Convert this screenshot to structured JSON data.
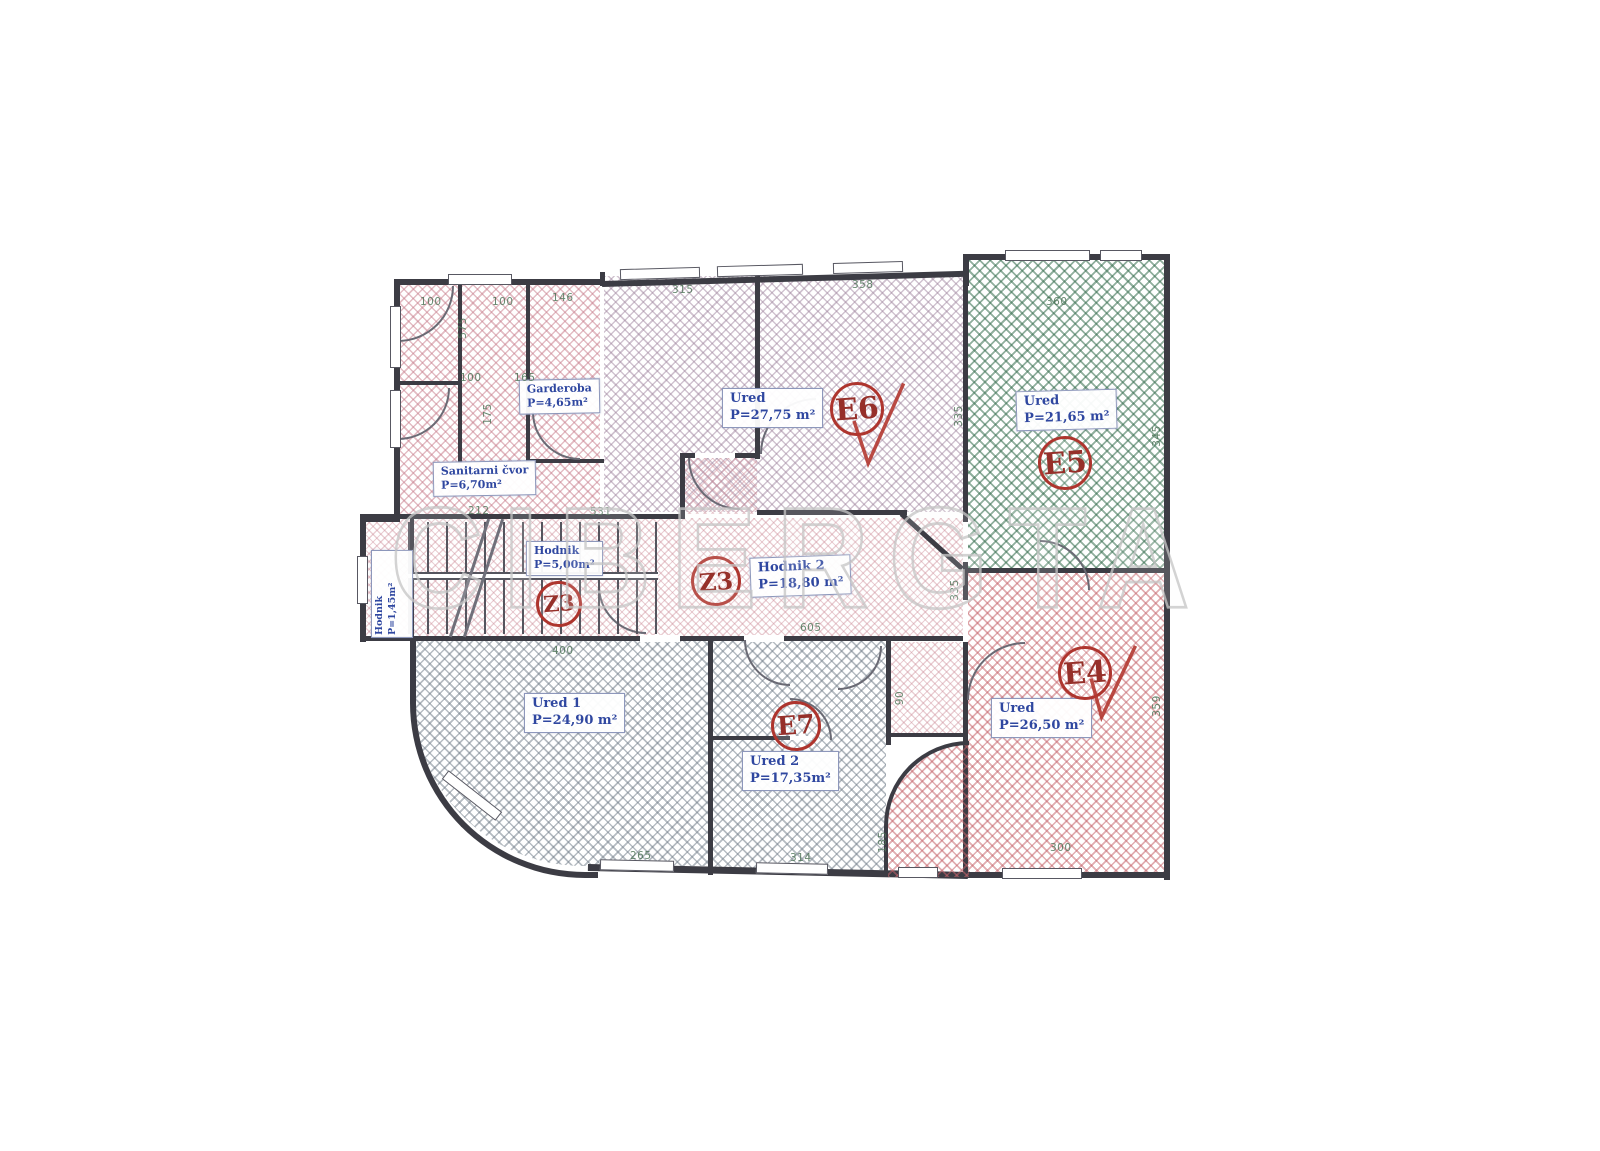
{
  "watermark": {
    "text": "CIBERGTA"
  },
  "colors": {
    "wall": "#3c3c44",
    "label_text": "#2f47a0",
    "marker_red": "#ae352e",
    "hatch_pink": "#c77b8a",
    "hatch_green": "#366e4e",
    "hatch_red": "#c5636a",
    "hatch_gray": "#6e7a86",
    "dim_green": "#4e7458"
  },
  "rooms": {
    "garderoba": {
      "name": "Garderoba",
      "area": "P=4,65m²"
    },
    "sanitarni": {
      "name": "Sanitarni čvor",
      "area": "P=6,70m²"
    },
    "ured_e6": {
      "name": "Ured",
      "area": "P=27,75 m²"
    },
    "ured_e5": {
      "name": "Ured",
      "area": "P=21,65 m²"
    },
    "ured_e4": {
      "name": "Ured",
      "area": "P=26,50 m²"
    },
    "ured1": {
      "name": "Ured 1",
      "area": "P=24,90 m²"
    },
    "ured2": {
      "name": "Ured 2",
      "area": "P=17,35m²"
    },
    "hodnik1": {
      "name": "Hodnik",
      "area": "P=5,00m²"
    },
    "hodnik2": {
      "name": "Hodnik 2",
      "area": "P=18,80 m²"
    },
    "hodnik3": {
      "name": "Hodnik",
      "area": "P=1,45m²"
    }
  },
  "markers": {
    "e4": "E4",
    "e5": "E5",
    "e6": "E6",
    "e7": "E7",
    "z3a": "Z3",
    "z3b": "Z3"
  },
  "dims": [
    {
      "t": "100"
    },
    {
      "t": "100"
    },
    {
      "t": "146"
    },
    {
      "t": "315"
    },
    {
      "t": "358"
    },
    {
      "t": "360"
    },
    {
      "t": "575"
    },
    {
      "t": "100"
    },
    {
      "t": "165"
    },
    {
      "t": "175"
    },
    {
      "t": "212"
    },
    {
      "t": "531"
    },
    {
      "t": "335"
    },
    {
      "t": "345"
    },
    {
      "t": "605"
    },
    {
      "t": "400"
    },
    {
      "t": "335"
    },
    {
      "t": "265"
    },
    {
      "t": "314"
    },
    {
      "t": "185"
    },
    {
      "t": "300"
    },
    {
      "t": "359"
    },
    {
      "t": "90"
    }
  ]
}
